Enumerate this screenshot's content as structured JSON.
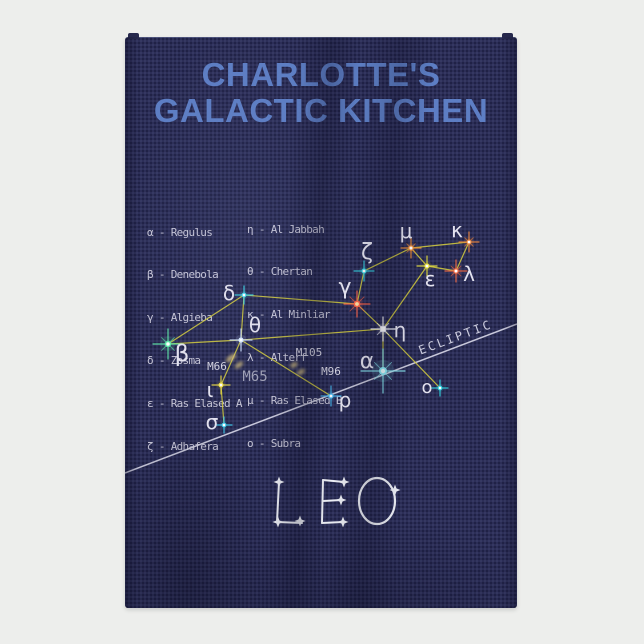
{
  "product": {
    "background_color": "#edeeec",
    "towel_color": "#2c2e57"
  },
  "title": {
    "line1": "CHARLOTTE'S",
    "line2": "GALACTIC KITCHEN",
    "color": "#5d7ec4"
  },
  "legend": {
    "left": [
      "α - Regulus",
      "β - Denebola",
      "γ - Algieba",
      "δ - Zosma",
      "ε - Ras Elased A",
      "ζ - Adhafera"
    ],
    "right": [
      "η - Al Jabbah",
      "θ - Chertan",
      "κ - Al Minliar",
      "λ - Alterf",
      "μ - Ras Elased B",
      "o - Subra"
    ]
  },
  "chart_data": {
    "type": "constellation-diagram",
    "constellation_name": "LEO",
    "line_color": "#d2cb3e",
    "label_color": "#e4e3ef",
    "stars": [
      {
        "id": "alpha",
        "label": "α",
        "name": "Regulus",
        "x": 258,
        "y": 334,
        "r": 4.0,
        "spike": 22,
        "diag": 12,
        "color": "#8eeef8",
        "core_color": "#eafeff",
        "labelX": 242,
        "labelY": 331,
        "labelSize": 22
      },
      {
        "id": "beta",
        "label": "β",
        "name": "Denebola",
        "x": 43,
        "y": 307,
        "r": 3.2,
        "spike": 15,
        "diag": 9,
        "color": "#5fe9a9",
        "labelX": 57,
        "labelY": 324,
        "labelSize": 23
      },
      {
        "id": "gamma",
        "label": "γ",
        "name": "Algieba",
        "x": 232,
        "y": 267,
        "r": 3.4,
        "spike": 13,
        "diag": 10,
        "color": "#ff6448",
        "core_color": "#ffe2a6",
        "labelX": 220,
        "labelY": 257,
        "labelSize": 22
      },
      {
        "id": "delta",
        "label": "δ",
        "name": "Zosma",
        "x": 119,
        "y": 258,
        "r": 2.4,
        "spike": 9,
        "color": "#3fd8e8",
        "labelX": 104,
        "labelY": 263,
        "labelSize": 20
      },
      {
        "id": "epsilon",
        "label": "ε",
        "name": "Ras Elased A",
        "x": 302,
        "y": 229,
        "r": 2.6,
        "spike": 10,
        "color": "#e6e040",
        "labelX": 305,
        "labelY": 249,
        "labelSize": 20
      },
      {
        "id": "zeta",
        "label": "ζ",
        "name": "Adhafera",
        "x": 239,
        "y": 234,
        "r": 2.6,
        "spike": 10,
        "color": "#38cfe0",
        "labelX": 242,
        "labelY": 222,
        "labelSize": 22
      },
      {
        "id": "eta",
        "label": "η",
        "name": "Al Jabbah",
        "x": 258,
        "y": 292,
        "r": 3.0,
        "spike": 12,
        "diag": 8,
        "color": "#ffffff",
        "core": "square",
        "labelX": 275,
        "labelY": 300,
        "labelSize": 20
      },
      {
        "id": "theta",
        "label": "θ",
        "name": "Chertan",
        "x": 116,
        "y": 303,
        "r": 2.6,
        "spike": 11,
        "color": "#cfe2ff",
        "labelX": 130,
        "labelY": 295,
        "labelSize": 20
      },
      {
        "id": "iota",
        "label": "ι",
        "name": "Iota",
        "x": 96,
        "y": 348,
        "r": 2.6,
        "spike": 9,
        "color": "#e8d83e",
        "labelX": 85,
        "labelY": 360,
        "labelSize": 20
      },
      {
        "id": "kappa",
        "label": "κ",
        "name": "Al Minliar",
        "x": 344,
        "y": 205,
        "r": 2.6,
        "spike": 10,
        "diag": 6,
        "color": "#e8843c",
        "labelX": 332,
        "labelY": 200,
        "labelSize": 20
      },
      {
        "id": "lambda",
        "label": "λ",
        "name": "Alterf",
        "x": 331,
        "y": 234,
        "r": 2.8,
        "spike": 11,
        "diag": 7,
        "color": "#ef6a45",
        "labelX": 344,
        "labelY": 244,
        "labelSize": 20
      },
      {
        "id": "mu",
        "label": "μ",
        "name": "Ras Elased B",
        "x": 286,
        "y": 211,
        "r": 2.8,
        "spike": 10,
        "diag": 6,
        "color": "#ef8f3a",
        "labelX": 281,
        "labelY": 201,
        "labelSize": 20
      },
      {
        "id": "omicron",
        "label": "o",
        "name": "Subra",
        "x": 315,
        "y": 351,
        "r": 2.4,
        "spike": 8,
        "color": "#2fd0dd",
        "labelX": 302,
        "labelY": 356,
        "labelSize": 18
      },
      {
        "id": "rho",
        "label": "ρ",
        "name": "Rho",
        "x": 206,
        "y": 359,
        "r": 2.6,
        "spike": 10,
        "color": "#49b9ef",
        "labelX": 220,
        "labelY": 370,
        "labelSize": 20
      },
      {
        "id": "sigma",
        "label": "σ",
        "name": "Sigma",
        "x": 99,
        "y": 388,
        "r": 2.4,
        "spike": 8,
        "color": "#3cc8e8",
        "labelX": 87,
        "labelY": 392,
        "labelSize": 20
      }
    ],
    "connections": [
      [
        "beta",
        "delta"
      ],
      [
        "beta",
        "theta"
      ],
      [
        "delta",
        "theta"
      ],
      [
        "delta",
        "gamma"
      ],
      [
        "theta",
        "eta"
      ],
      [
        "theta",
        "iota"
      ],
      [
        "theta",
        "rho"
      ],
      [
        "iota",
        "sigma"
      ],
      [
        "gamma",
        "zeta"
      ],
      [
        "gamma",
        "eta"
      ],
      [
        "zeta",
        "mu"
      ],
      [
        "mu",
        "kappa"
      ],
      [
        "mu",
        "epsilon"
      ],
      [
        "kappa",
        "lambda"
      ],
      [
        "lambda",
        "epsilon"
      ],
      [
        "epsilon",
        "eta"
      ],
      [
        "eta",
        "alpha"
      ],
      [
        "eta",
        "omicron"
      ]
    ],
    "messier_labels": [
      {
        "label": "M66",
        "x": 92,
        "y": 333,
        "size": 11
      },
      {
        "label": "M65",
        "x": 130,
        "y": 344,
        "size": 14,
        "dim": true
      },
      {
        "label": "M105",
        "x": 184,
        "y": 319,
        "size": 11
      },
      {
        "label": "M96",
        "x": 206,
        "y": 338,
        "size": 11
      }
    ],
    "galaxy_blobs": [
      {
        "x": 106,
        "y": 321,
        "rx": 6.0,
        "ry": 2.6,
        "rot": -38
      },
      {
        "x": 114,
        "y": 328,
        "rx": 5.0,
        "ry": 2.2,
        "rot": -38
      },
      {
        "x": 169,
        "y": 328,
        "rx": 4.0,
        "ry": 2.4,
        "rot": -30
      },
      {
        "x": 176,
        "y": 335,
        "rx": 4.5,
        "ry": 2.4,
        "rot": -30
      }
    ],
    "ecliptic": {
      "label": "ECLIPTIC",
      "from": [
        0,
        436
      ],
      "to": [
        392,
        287
      ],
      "label_pos": [
        332,
        304
      ],
      "label_angle": -20.5,
      "color": "#d6d6e6"
    },
    "wordmark": {
      "text": "LEO",
      "color": "#eef0f6",
      "strokes": [
        [
          [
            154,
            445
          ],
          [
            152,
            485
          ],
          [
            177,
            486
          ]
        ],
        [
          [
            198,
            443
          ],
          [
            197,
            486
          ]
        ],
        [
          [
            198,
            443
          ],
          [
            219,
            445
          ]
        ],
        [
          [
            198,
            464
          ],
          [
            216,
            463
          ]
        ],
        [
          [
            197,
            486
          ],
          [
            218,
            485
          ]
        ]
      ],
      "ellipse": {
        "cx": 252,
        "cy": 464,
        "rx": 18,
        "ry": 23
      },
      "stars": [
        [
          154,
          445
        ],
        [
          153,
          485
        ],
        [
          175,
          484
        ],
        [
          219,
          445
        ],
        [
          216,
          463
        ],
        [
          218,
          485
        ],
        [
          270,
          453
        ]
      ]
    }
  }
}
